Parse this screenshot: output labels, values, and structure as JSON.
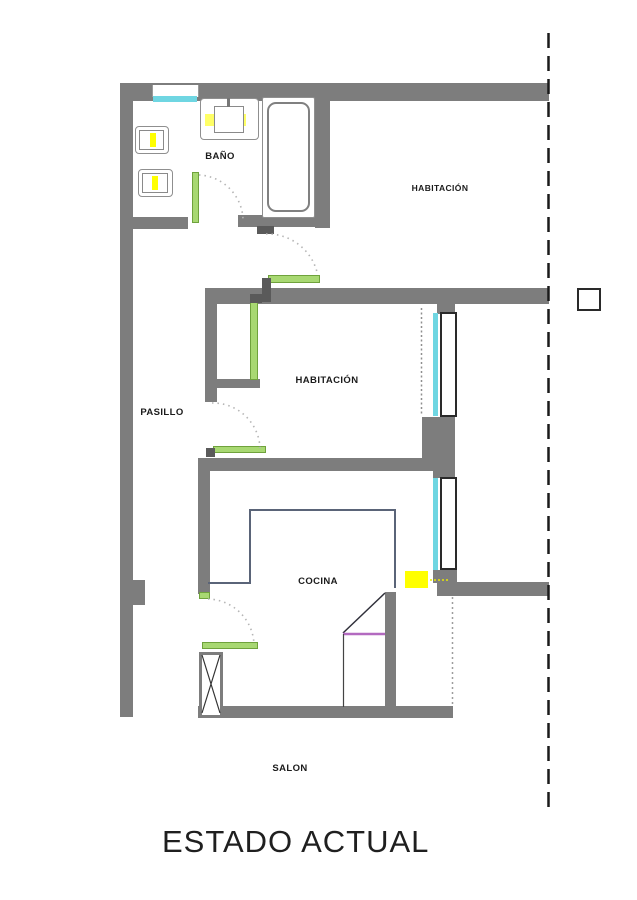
{
  "title": "ESTADO ACTUAL",
  "rooms": {
    "bano": "BAÑO",
    "habitacion_top": "HABITACIÓN",
    "habitacion_mid": "HABITACIÓN",
    "pasillo": "PASILLO",
    "cocina": "COCINA",
    "salon": "SALON"
  },
  "colors": {
    "wall": "#7d7d7d",
    "wall_dark": "#5a5a5a",
    "door": "#a8d872",
    "door_border": "#6fa23c",
    "window": "#6fd6e2",
    "highlight": "#ffff00",
    "counter": "#5a6478",
    "accent_purple": "#b36ac0",
    "arc": "#b5b5b5",
    "boundary": "#1a1a1a"
  }
}
